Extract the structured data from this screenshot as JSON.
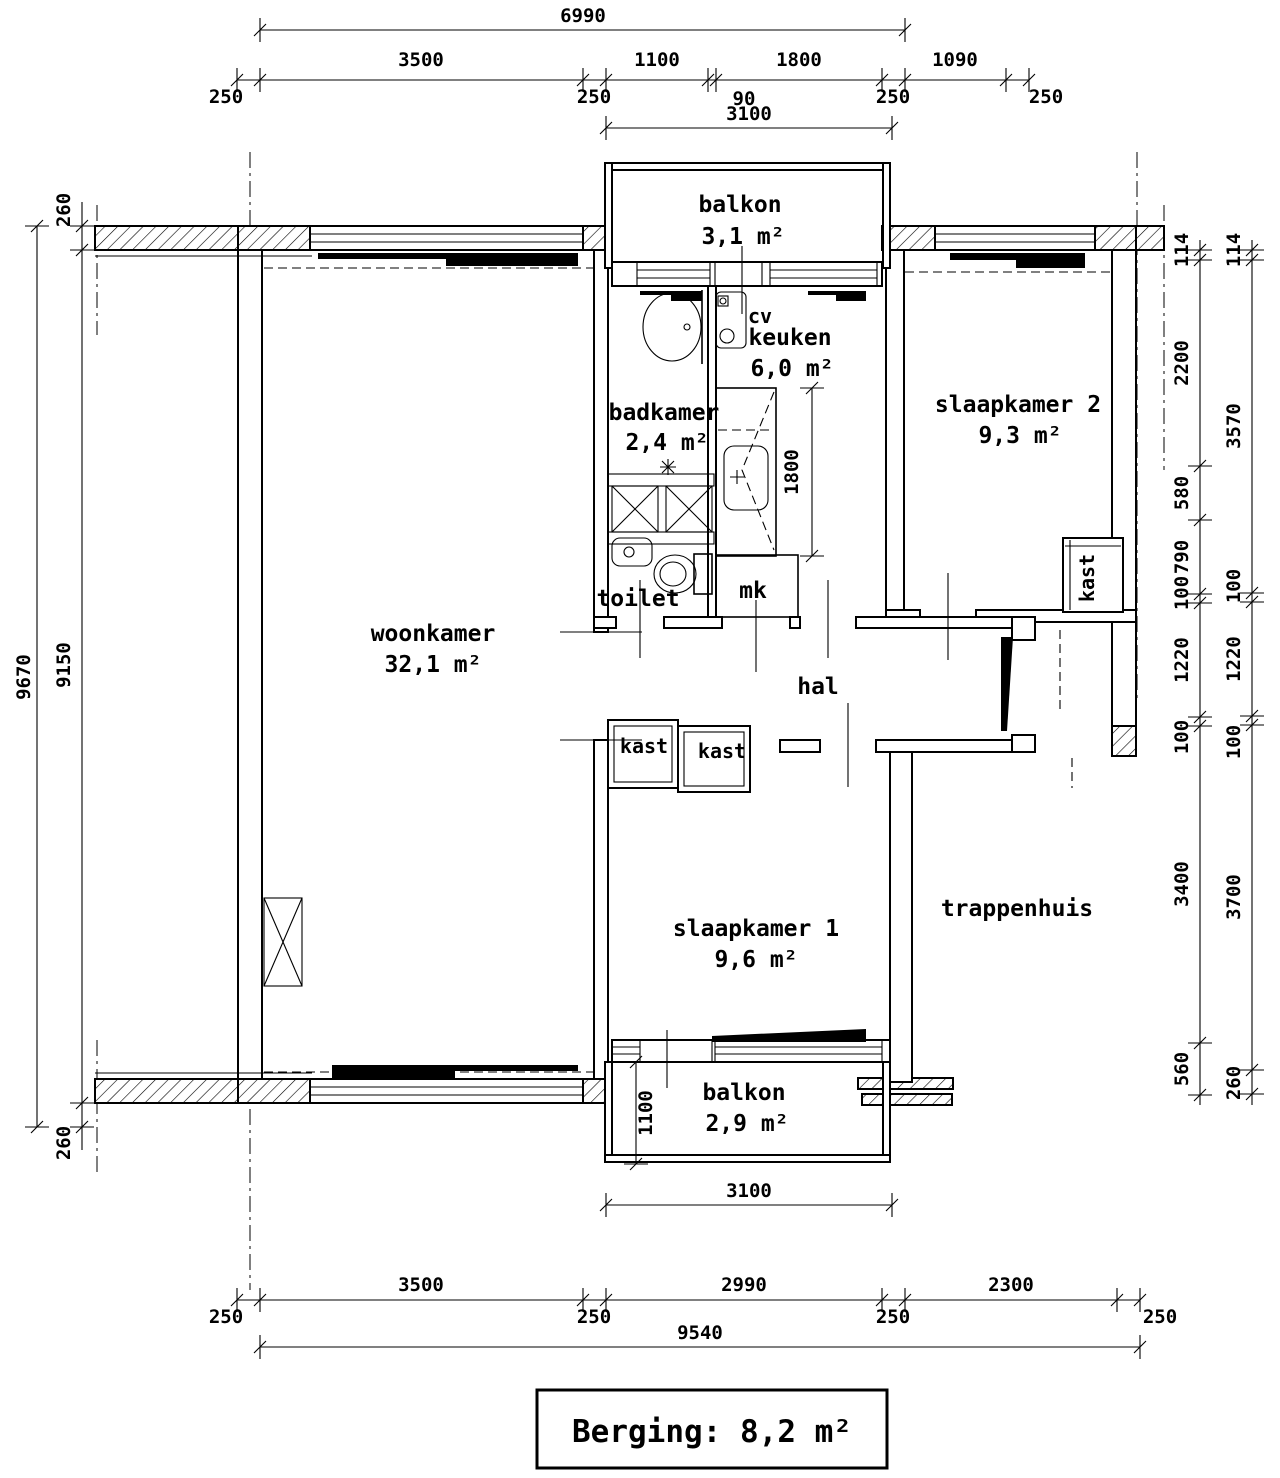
{
  "labels": {
    "woonkamer": {
      "name": "woonkamer",
      "area": "32,1 m²"
    },
    "keuken": {
      "name": "keuken",
      "area": "6,0 m²"
    },
    "badkamer": {
      "name": "badkamer",
      "area": "2,4 m²"
    },
    "slaapkamer2": {
      "name": "slaapkamer 2",
      "area": "9,3 m²"
    },
    "slaapkamer1": {
      "name": "slaapkamer 1",
      "area": "9,6 m²"
    },
    "balkon_noord": {
      "name": "balkon",
      "area": "3,1 m²"
    },
    "balkon_zuid": {
      "name": "balkon",
      "area": "2,9 m²"
    },
    "hal": "hal",
    "toilet": "toilet",
    "trappenhuis": "trappenhuis",
    "mk": "mk",
    "cv": "cv",
    "kast": "kast"
  },
  "dimensions": {
    "top": {
      "overall": "6990",
      "above": [
        "3500",
        "1100",
        "1800",
        "1090"
      ],
      "below": [
        "250",
        "250",
        "90",
        "250",
        "250"
      ],
      "balkon": "3100"
    },
    "bottom": {
      "above": [
        "3500",
        "2990",
        "2300"
      ],
      "below": [
        "250",
        "250",
        "250",
        "250"
      ],
      "overall": "9540",
      "balkon": "3100",
      "balkon_diepte": "1100"
    },
    "left": {
      "overall": "9670",
      "segments": [
        "260",
        "9150",
        "260"
      ]
    },
    "right": {
      "inner": [
        "114",
        "2200",
        "580",
        "790",
        "100",
        "1220",
        "100",
        "3400",
        "560"
      ],
      "outer": [
        "114",
        "3570",
        "100",
        "1220",
        "100",
        "3700",
        "260"
      ]
    },
    "keuken_aanrecht": "1800"
  },
  "footer": {
    "berging": "Berging: 8,2 m²"
  }
}
